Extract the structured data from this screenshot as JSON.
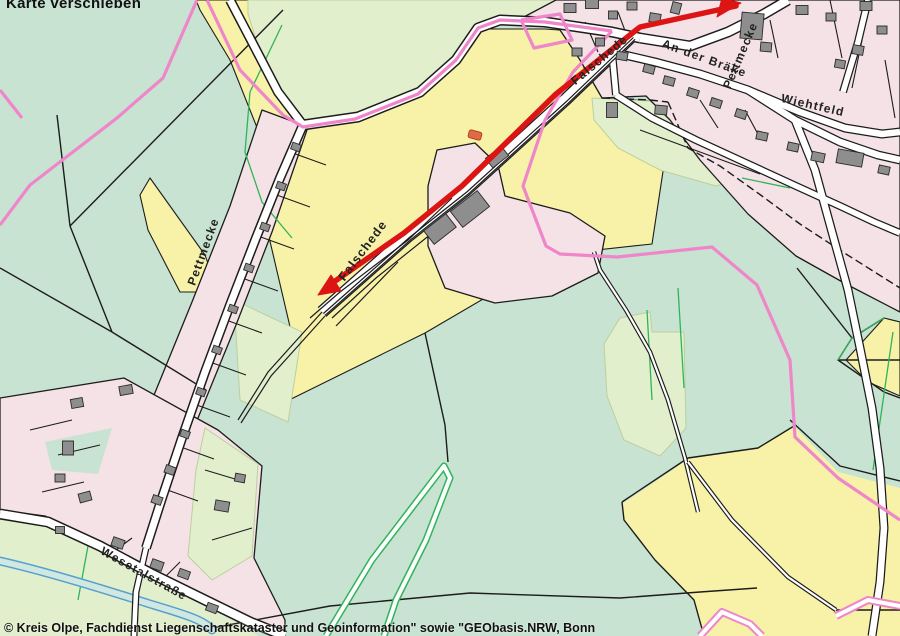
{
  "map": {
    "pan_hint": "Karte verschieben",
    "copyright": "© Kreis Olpe, Fachdienst Liegenschaftskataster und Geoinformation\" sowie \"GEObasis.NRW, Bonn",
    "street_labels": {
      "pettmecke_west": "Pettmecke",
      "falschede_mid": "Falschede",
      "falschede_top": "Falschede",
      "an_der_braeke": "An der Bräke",
      "pettmecke_north": "Pettmecke",
      "wiehtfeld": "Wiehtfeld",
      "wesetalstrasse": "Wesetalstraße"
    },
    "annotation": {
      "type": "route-arrow",
      "double_headed": true,
      "color": "#dc1414"
    },
    "palette": {
      "meadow_teal": "#c8e3d2",
      "field_yellow": "#f8f2a8",
      "grass_pale": "#e2efcd",
      "residential_pink": "#f4e2e6",
      "road_white": "#ffffff",
      "building_gray": "#8e8e8e",
      "building_orange": "#e06a44",
      "boundary_pink": "#ee86c9",
      "boundary_black": "#1c1c1c",
      "vegetation_green": "#2eb45a",
      "water_blue": "#58a0cc"
    }
  }
}
